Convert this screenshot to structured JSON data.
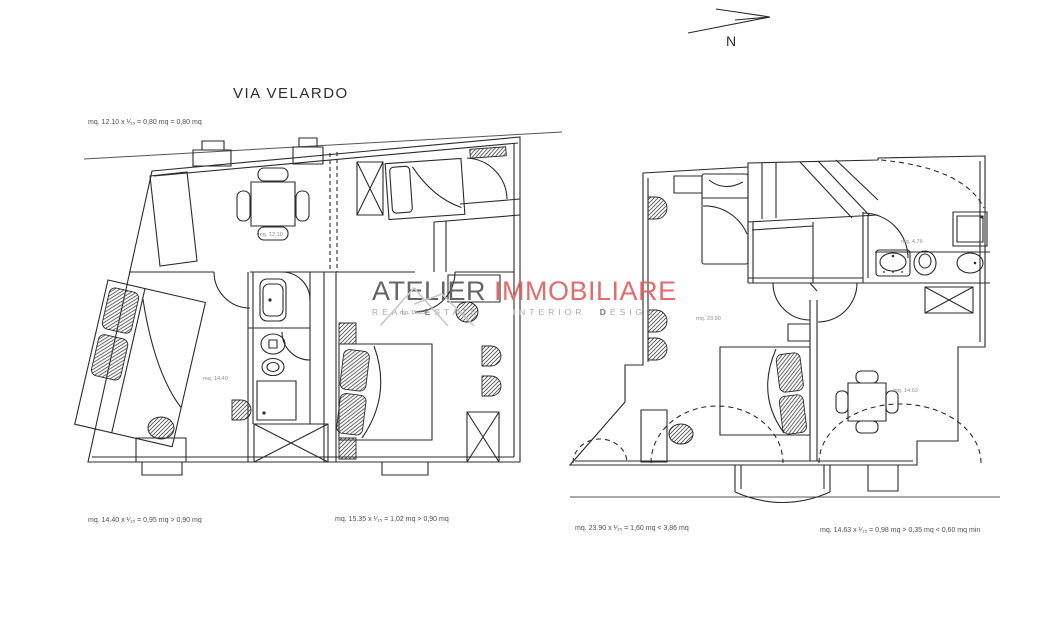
{
  "page": {
    "street_label": "VIA VELARDO",
    "north_label": "N"
  },
  "annotations": {
    "top_left": "mq. 12.10 x ¹⁄₁₅ = 0,80 mq = 0,80 mq",
    "bottom_left_1": "mq. 14.40 x ¹⁄₁₅ = 0,95 mq > 0,90 mq",
    "bottom_left_2": "mq. 15.35 x ¹⁄₁₅ = 1,02 mq > 0,90 mq",
    "bottom_right_1": "mq. 23.90 x ¹⁄₁₅ = 1,60 mq < 3,86 mq",
    "bottom_right_2": "mq. 14.63 x ¹⁄₁₅ = 0,98 mq > 0,35 mq < 0,60 mq min"
  },
  "plan_left": {
    "rooms": [
      {
        "label": "mq. 12.10"
      },
      {
        "label": "mq. 14.40"
      },
      {
        "label": "mq. 15.35"
      }
    ]
  },
  "plan_right": {
    "rooms": [
      {
        "label": "mq. 23.90"
      },
      {
        "label": "mq. 4.76"
      },
      {
        "label": "mq. 14.63"
      }
    ]
  },
  "watermark": {
    "brand_gray": "ATELIER",
    "brand_red": "IMMOBILIARE",
    "tag_word_1": "REAL",
    "tag_word_2": "ESTATE",
    "tag_word_3": "INTERIOR",
    "tag_word_4": "DESIGN",
    "color_brand_gray": "#57585c",
    "color_brand_red": "#e25e60"
  }
}
